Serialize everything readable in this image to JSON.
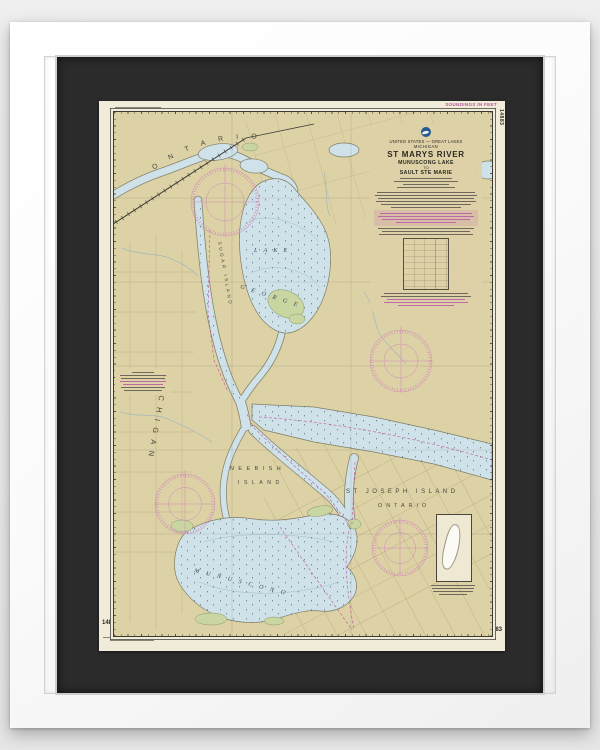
{
  "artwork": {
    "chart_number": "14883",
    "soundings": "SOUNDINGS IN FEET",
    "title_block": {
      "nation": "UNITED STATES — GREAT LAKES",
      "state": "MICHIGAN",
      "title": "ST MARYS RIVER",
      "sub1": "MUNUSCONG LAKE",
      "sub2": "TO",
      "sub3": "SAULT STE MARIE"
    },
    "place_labels": {
      "ontario_top": "ONTARIO",
      "michigan": "MICHIGAN",
      "sugar_island": "SUGAR ISLAND",
      "lake": "LAKE",
      "george": "GEORGE",
      "neebish": "NEEBISH",
      "island": "ISLAND",
      "st_joseph_island": "ST JOSEPH ISLAND",
      "ontario_south": "ONTARIO",
      "munuscong": "MUNUSCONG"
    },
    "colors": {
      "land": "#ddd1a6",
      "water": "#cfe2ea",
      "marsh": "#c9d6a2",
      "note_magenta": "#b5579d",
      "mat": "#2b2b2b"
    }
  }
}
